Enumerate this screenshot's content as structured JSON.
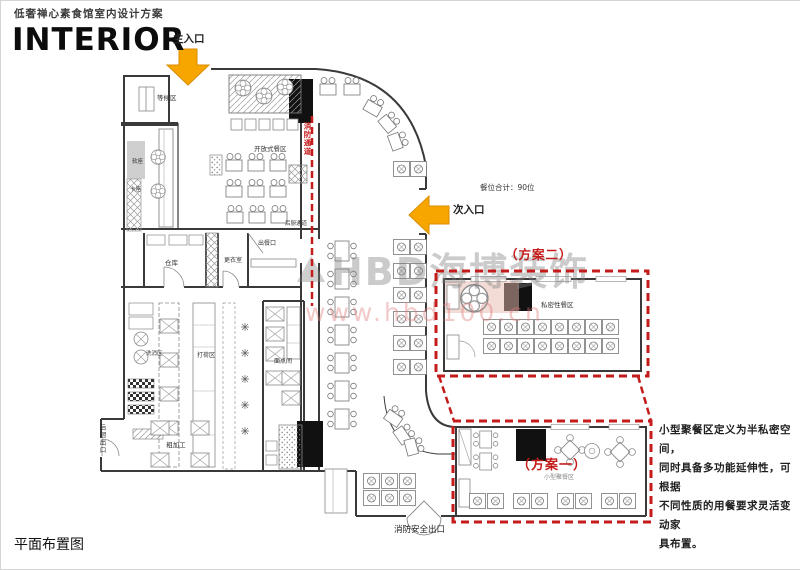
{
  "page": {
    "subtitle": "低奢禅心素食馆室内设计方案",
    "title": "INTERIOR",
    "footer": "平面布置图"
  },
  "entrances": {
    "main": "主入口",
    "secondary": "次入口"
  },
  "stats": {
    "seat_total": "餐位合计：90位"
  },
  "plans": {
    "plan2": {
      "label": "（方案二）",
      "area_label": "私密性餐区"
    },
    "plan1": {
      "label": "（方案一）",
      "area_label": "小型聚餐区"
    }
  },
  "note": {
    "line1": "小型聚餐区定义为半私密空间，",
    "line2": "同时具备多功能延伸性，可根据",
    "line3": "不同性质的用餐要求灵活变动家",
    "line4": "具布置。"
  },
  "rooms": {
    "waiting": "等候区",
    "open_dining": "开放式餐区",
    "storage": "仓库",
    "changing_room": "更衣室",
    "serving_window": "出餐口",
    "soft_seating": "软座",
    "booth_seating": "卡座",
    "wash_area": "洗消区",
    "prep_area": "打荷区",
    "pastry_room": "面点间",
    "rough_prep": "粗加工",
    "kitchen_corridor": "后厨通道"
  },
  "exits": {
    "fire_exit": "消防安全出口",
    "fire_passage": "消防通道",
    "kitchen_exit": "后厨出口"
  },
  "watermark": {
    "brand": "HBD海博装饰",
    "url": "www.hbd100.cn"
  },
  "colors": {
    "accent_red": "#c41b1b",
    "arrow_yellow": "#f7a600",
    "wall": "#3a3a3a",
    "pink_tint": "#e8b7ae"
  }
}
